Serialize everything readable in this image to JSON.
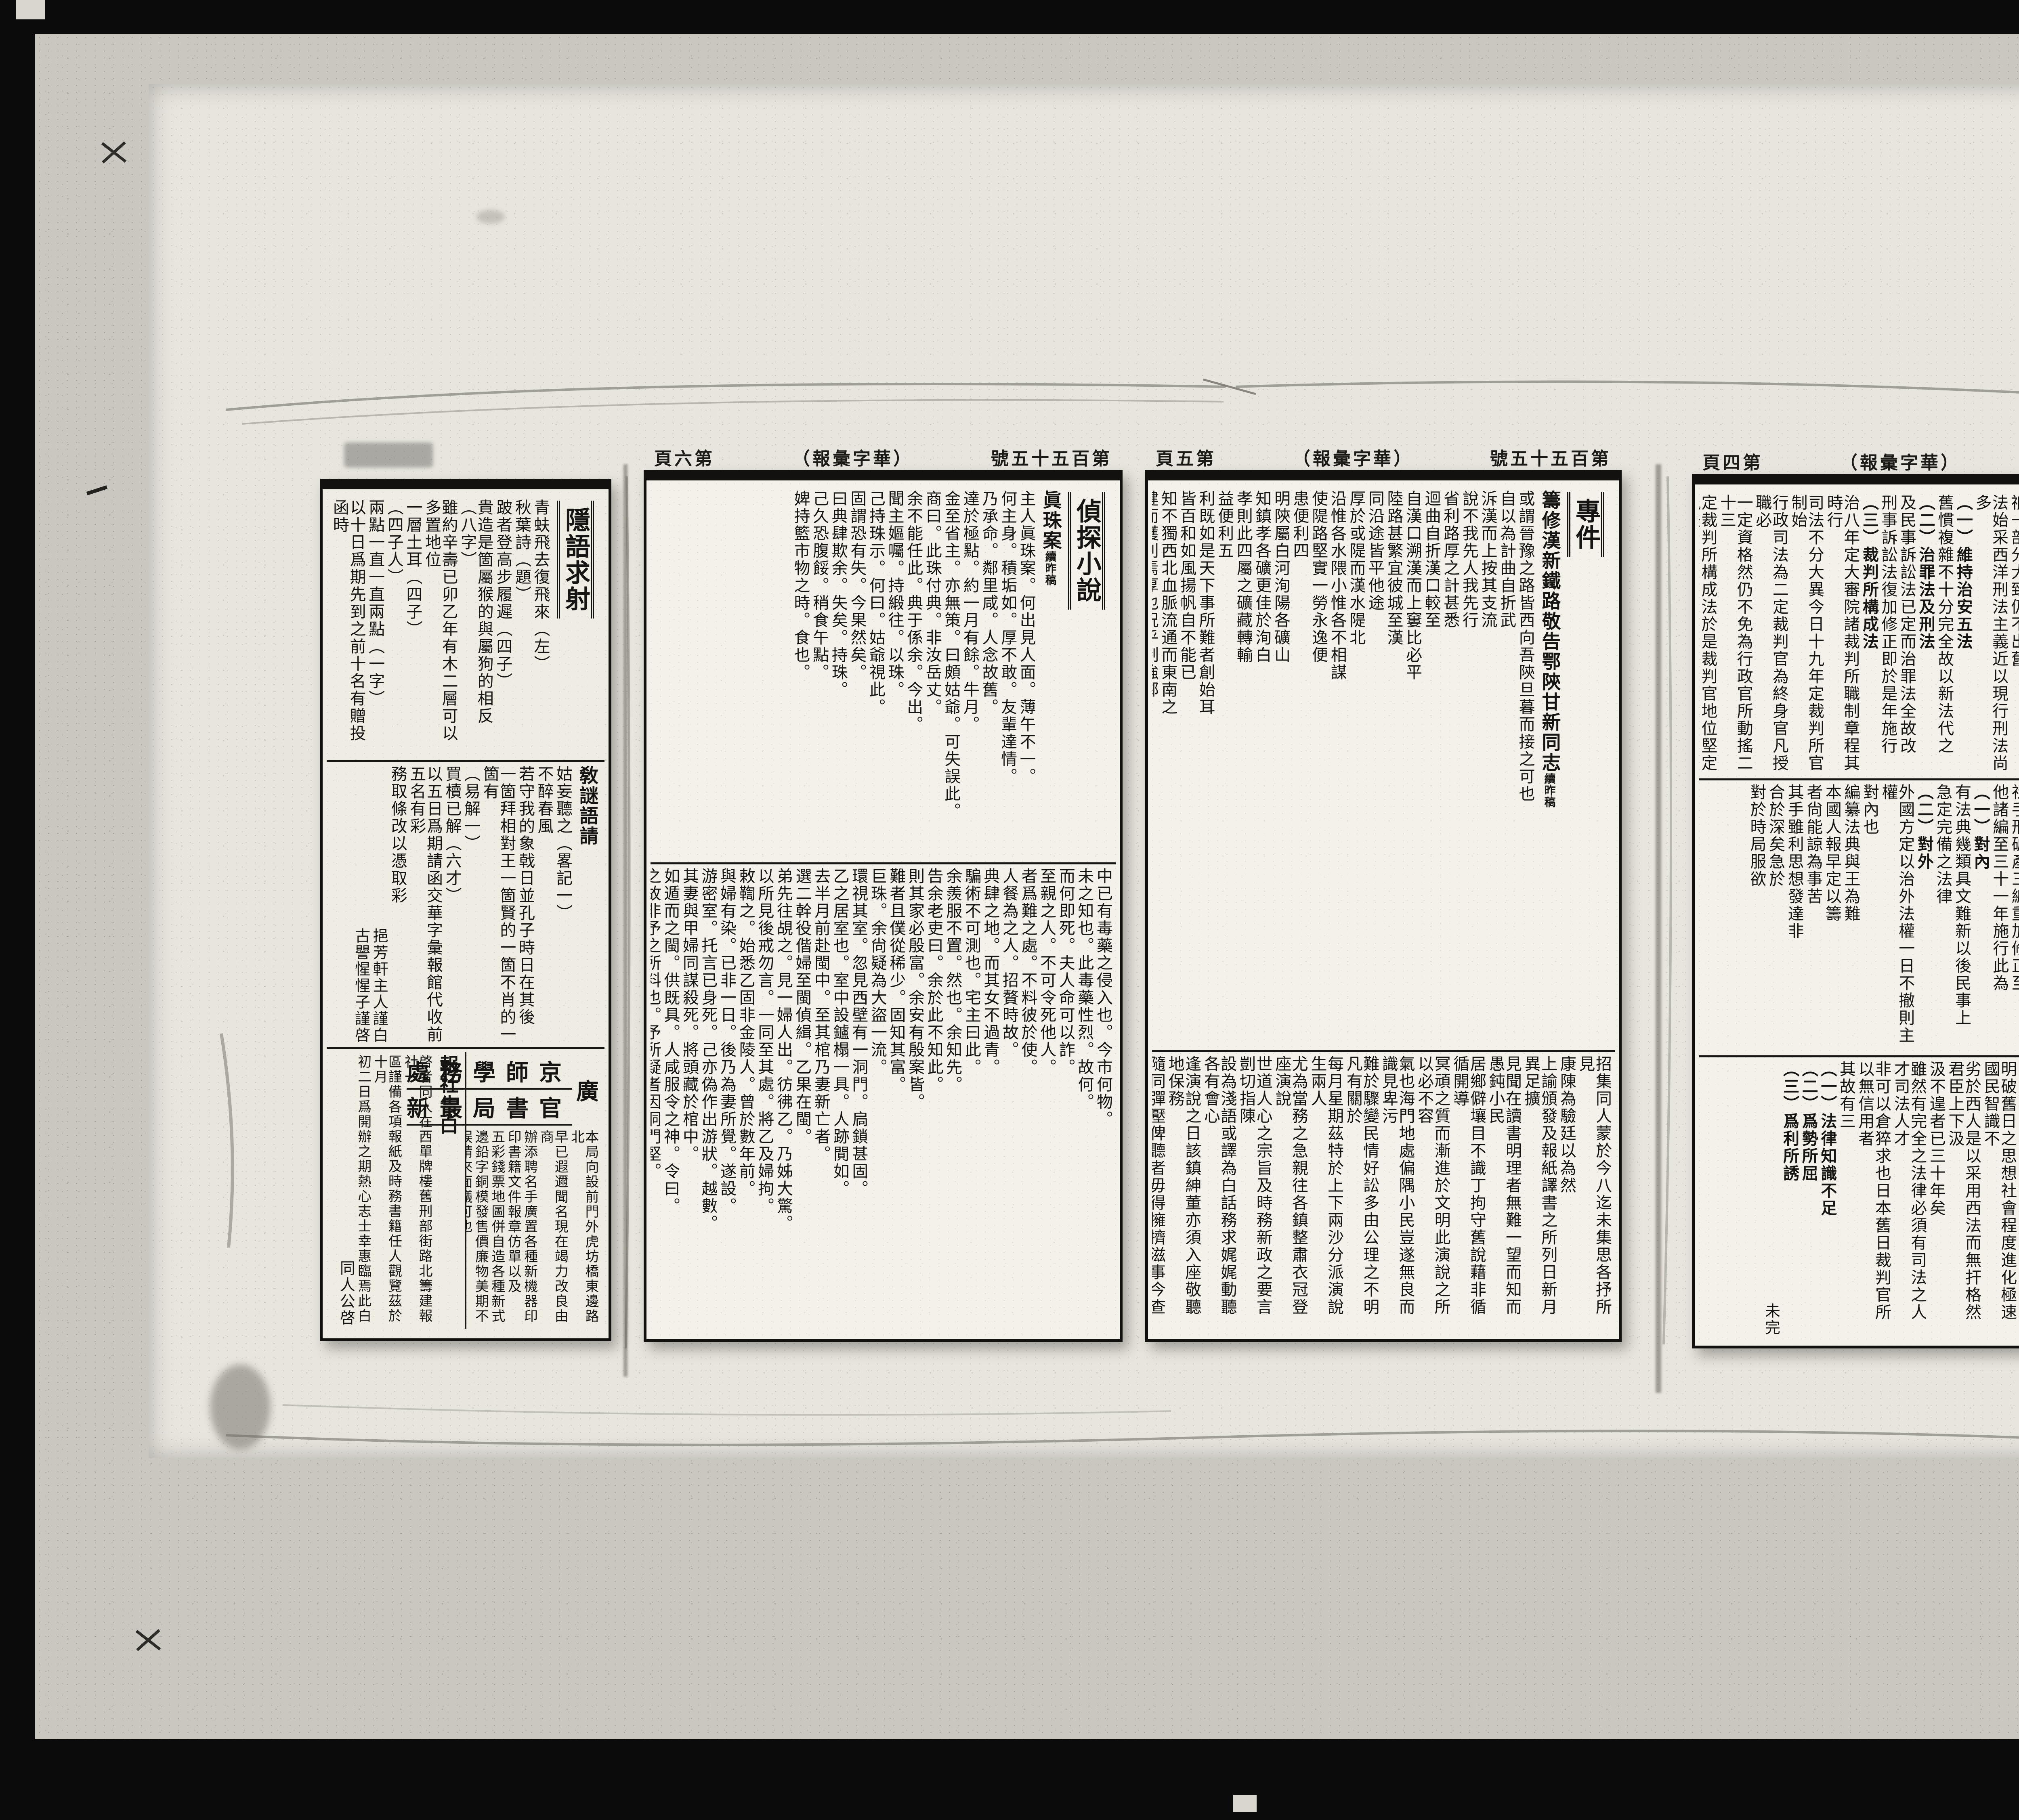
{
  "publication": {
    "issue": "第百五十五號",
    "name": "華字彙報",
    "name_paren": "（華字彙報）"
  },
  "panels": [
    {
      "page_label": null,
      "head": null,
      "blocks": [
        {
          "columns": [
            {
              "kind": "title",
              "text": "隱語求射"
            },
            {
              "kind": "body",
              "text": "青蚨飛去復飛來（左）"
            },
            {
              "kind": "body",
              "text": "秋葉詩（題）"
            },
            {
              "kind": "body",
              "text": "跛者登高步履遲（四子）"
            },
            {
              "kind": "body",
              "text": "貴造是箇屬猴的與屬狗的相反（八字）"
            },
            {
              "kind": "body",
              "text": "雖約辛壽已卯乙年有木二層可以多置地位"
            },
            {
              "kind": "body",
              "text": "一層土耳（四子）"
            },
            {
              "kind": "body",
              "text": "（四子人）"
            },
            {
              "kind": "body",
              "text": "兩點一直一直兩點（一字）"
            },
            {
              "kind": "body",
              "text": "以十日爲期先到之前十名有贈投函時"
            }
          ]
        },
        {
          "columns": [
            {
              "kind": "headline",
              "text": "敎謎語請"
            },
            {
              "kind": "body",
              "text": "姑妄聽之（畧記一）"
            },
            {
              "kind": "body",
              "text": "不醉春風"
            },
            {
              "kind": "body",
              "text": "若守我的象戟日並孔子時日在其後"
            },
            {
              "kind": "body",
              "text": "一箇拜相對王一箇賢的一箇不肖的一箇有"
            },
            {
              "kind": "body",
              "text": "（易解一）"
            },
            {
              "kind": "body",
              "text": "買櫝已解（六才）"
            },
            {
              "kind": "body",
              "text": "以五日爲期請函交華字彙報館代收前五名有彩"
            },
            {
              "kind": "body",
              "text": "務取條改以憑取彩"
            },
            {
              "kind": "sign",
              "text": "挹芳軒主人謹白"
            },
            {
              "kind": "sign",
              "text": "古譻惺惺子謹啓"
            }
          ]
        },
        {
          "split": true,
          "right": {
            "banner_rows": [
              "京師學務處",
              "官書局最新"
            ],
            "banner_side": "廣",
            "columns": [
              {
                "kind": "small",
                "text": "本局向設前門外虎坊橋東邊路北"
              },
              {
                "kind": "small",
                "text": "早已遐邇聞名現在竭力改良由商"
              },
              {
                "kind": "small",
                "text": "辦添聘名手廣置各種新機器印"
              },
              {
                "kind": "small",
                "text": "印書籍文件報章仿單以及"
              },
              {
                "kind": "small",
                "text": "五彩錢票地圖併自造各種新式"
              },
              {
                "kind": "small",
                "text": "邊鉛字銅模發售價廉物美期不"
              },
              {
                "kind": "small",
                "text": "誤請來面議可也"
              }
            ]
          },
          "left": {
            "columns": [
              {
                "kind": "headline",
                "text": "報社告白"
              },
              {
                "kind": "small",
                "text": "啓者同人在西單牌樓舊刑部街路北籌建報社一"
              },
              {
                "kind": "small",
                "text": "區謹備各項報紙及時務書籍任人觀覽茲於十月"
              },
              {
                "kind": "small",
                "text": "初二日爲開辦之期熱心志士幸惠臨焉此白"
              },
              {
                "kind": "sign",
                "text": "同人公啓"
              }
            ]
          }
        }
      ]
    },
    {
      "page_label": "第六頁",
      "head": {
        "issue": "第百五十五號",
        "paper": "（華字彙報）",
        "page": "第六頁"
      },
      "blocks": [
        {
          "columns": [
            {
              "kind": "title",
              "text": "偵探小說"
            },
            {
              "kind": "headline",
              "text": "眞珠案",
              "sub": "續昨稿"
            },
            {
              "kind": "body",
              "text": "主人眞珠案。何出見人面。薄午不一。"
            },
            {
              "kind": "body",
              "text": "何主身。積垢如。厚不敢。友輩達情。"
            },
            {
              "kind": "body",
              "text": "乃承命。鄰里咸。人念故舊。"
            },
            {
              "kind": "body",
              "text": "達於極點。約一月有餘。牛月。"
            },
            {
              "kind": "body",
              "text": "金至省主。亦無策。曰頗姑爺。可失誤此。"
            },
            {
              "kind": "body",
              "text": "商曰。此珠付典。非汝岳丈。"
            },
            {
              "kind": "body",
              "text": "余不能任此。典于係余。今出。"
            },
            {
              "kind": "body",
              "text": "聞主嫗囑。持緞往。以珠。"
            },
            {
              "kind": "body",
              "text": "己持珠示。何曰。姑爺視此。"
            },
            {
              "kind": "body",
              "text": "固謂恐有失。今果然矣。"
            },
            {
              "kind": "body",
              "text": "曰典肆欺余。失矣。持珠。"
            },
            {
              "kind": "body",
              "text": "己久恐腹餒。稍食午點。"
            },
            {
              "kind": "body",
              "text": "婢持籃市物之時。食也。"
            }
          ]
        },
        {
          "columns": [
            {
              "kind": "body",
              "text": "中已有毒藥之侵入也。今市何物。"
            },
            {
              "kind": "body",
              "text": "未之知也。此毒藥性烈。故何。"
            },
            {
              "kind": "body",
              "text": "而何即死。夫人命可以詐。"
            },
            {
              "kind": "body",
              "text": "至親之人。不可令死他人。"
            },
            {
              "kind": "body",
              "text": "者爲難之處。不料彼於使。"
            },
            {
              "kind": "body",
              "text": "人餐為之人。招贅時故。"
            },
            {
              "kind": "body",
              "text": "典肆之地。而其女不過青。"
            },
            {
              "kind": "body",
              "text": "騙術不可測也。宅主曰此。"
            },
            {
              "kind": "body",
              "text": "余羨服不置。然也。余知先。"
            },
            {
              "kind": "body",
              "text": "告余老吏曰。余於此不知此。"
            },
            {
              "kind": "body",
              "text": "則其家必殷富。余安有殷案皆。"
            },
            {
              "kind": "body",
              "text": "難者且僕從稀少。固知其富。"
            },
            {
              "kind": "body",
              "text": "巨珠。余尙疑為大盜一流。"
            },
            {
              "kind": "body",
              "text": "環視其室。忽見西壁有一洞門。扃鎖甚固。"
            },
            {
              "kind": "body",
              "text": "乙之居室也。室中設鑪榻一具。人跡閴如。"
            },
            {
              "kind": "body",
              "text": "去半月前赴閩中。至其棺乃妻新亡者。"
            },
            {
              "kind": "body",
              "text": "選二幹役偕婦至閩偵緝。乙果在閩。"
            },
            {
              "kind": "body",
              "text": "弟先往覘之。見一婦人出。彷彿乙。乃姊大驚。"
            },
            {
              "kind": "body",
              "text": "以所見後戒勿言。一同至其處。將乙及婦拘。"
            },
            {
              "kind": "body",
              "text": "敕鞫之。始悉乙固非金陵人。曾於數年前。"
            },
            {
              "kind": "body",
              "text": "與婦有染。已非一日。後乃為妻所覺。遂設。"
            },
            {
              "kind": "body",
              "text": "游密室。托言已身死。己亦偽作出游狀。越數。"
            },
            {
              "kind": "body",
              "text": "其妻與甲婦同謀殺死。將頭藏於棺中。"
            },
            {
              "kind": "body",
              "text": "如遁而之閩。供既具。人咸服令之神。令曰。"
            },
            {
              "kind": "body",
              "text": "之故非予之所料也。予所疑者因洞門堅。"
            },
            {
              "kind": "body",
              "text": "甲婦者卽乙耳。距意尙有不盡然者乎。"
            }
          ]
        }
      ]
    },
    {
      "page_label": "第五頁",
      "head": {
        "issue": "第百五十五號",
        "paper": "（華字彙報）",
        "page": "第五頁"
      },
      "blocks": [
        {
          "columns": [
            {
              "kind": "title",
              "text": "專件"
            },
            {
              "kind": "headline",
              "text": "籌修漢新鐵路敬告鄂陝甘新同志",
              "sub": "續昨稿"
            },
            {
              "kind": "body",
              "text": "或謂晉豫之路皆西向吾陝旦暮而接之可也"
            },
            {
              "kind": "body",
              "text": "自以為計曲自折武"
            },
            {
              "kind": "body",
              "text": "泝漢而上按其支流"
            },
            {
              "kind": "body",
              "text": "說不我先人我先行"
            },
            {
              "kind": "body",
              "text": "省利路厚之計甚悉"
            },
            {
              "kind": "body",
              "text": "迴曲自折漢口較至"
            },
            {
              "kind": "body",
              "text": "自漢口溯漢而上窶比必平"
            },
            {
              "kind": "body",
              "text": "陸路甚繁宜彼城至漢"
            },
            {
              "kind": "body",
              "text": "同沿途皆平他途"
            },
            {
              "kind": "body",
              "text": "厚於或隄而漢水隄北"
            },
            {
              "kind": "body",
              "text": "沿惟各水隈小惟各不相謀"
            },
            {
              "kind": "body",
              "text": "使隄路堅實一勞永逸便"
            },
            {
              "kind": "body",
              "text": "患便利四"
            },
            {
              "kind": "body",
              "text": "明陝屬白河洵陽各礦山"
            },
            {
              "kind": "body",
              "text": "知鎮孝各礦更佳於洵白"
            },
            {
              "kind": "body",
              "text": "孝則此四屬之礦藏轉輸"
            },
            {
              "kind": "body",
              "text": "益便利五"
            },
            {
              "kind": "body",
              "text": "利既如是天下事所難者創始耳"
            },
            {
              "kind": "body",
              "text": "皆百和如風揚帆自不能已"
            },
            {
              "kind": "body",
              "text": "知不獨西北血脈流通而東南之"
            },
            {
              "kind": "body",
              "text": "健而獲利焉厚也況乎制強鄰"
            },
            {
              "kind": "body",
              "text": "憲近如李伯行京卿籌"
            },
            {
              "kind": "body",
              "text": "魯園方伯籌江西鐵路各"
            },
            {
              "kind": "body",
              "text": "左右籌畫各法詳盡無遺仿行猶反手也"
            },
            {
              "kind": "body",
              "text": "單事須由國家提倡但省同志合力共作"
            },
            {
              "kind": "body",
              "text": "任人理財民自主之"
            },
            {
              "kind": "body",
              "text": "省舊日義舉善會生息設立漢新鐵路總銀行"
            },
            {
              "kind": "body",
              "text": "於陝甘新酌設子行可仿國民義務募款之"
            },
            {
              "kind": "body",
              "text": "致富致強實基於此"
            }
          ]
        },
        {
          "columns": [
            {
              "kind": "body",
              "text": "招集同人蒙於今八迄未集思各抒所見"
            },
            {
              "kind": "body",
              "text": "康陳為驗廷以為然"
            },
            {
              "kind": "body",
              "text": "上諭頒發及報紙譯書之所列日新月異足擴"
            },
            {
              "kind": "body",
              "text": "見聞在讀書明理者無難一望而知而愚鈍小民"
            },
            {
              "kind": "body",
              "text": "居鄉僻壤目不識丁拘守舊說藉非循循開導"
            },
            {
              "kind": "body",
              "text": "冥頑之質而漸進於文明此演說之所以必不容"
            },
            {
              "kind": "body",
              "text": "氣也海門地處偏隅小民豈遂無良而識見卑污"
            },
            {
              "kind": "body",
              "text": "難於驟變民情好訟多由公理之不明凡有關於"
            },
            {
              "kind": "body",
              "text": "每月星期茲特於上下兩沙分派演說生兩人"
            },
            {
              "kind": "body",
              "text": "尤為當務之急親往各鎮整肅衣冠登座演說"
            },
            {
              "kind": "body",
              "text": "世道人心之宗旨及時務新政之要言剴切指陳"
            },
            {
              "kind": "body",
              "text": "設為淺語或譯為白話務求娓娓動聽各有會心"
            },
            {
              "kind": "body",
              "text": "逢演說之日該鎮紳董亦須入座敬聽地保務"
            },
            {
              "kind": "body",
              "text": "隨同彈壓俾聽者毋得擁擠滋事今查有上下沙"
            },
            {
              "kind": "body",
              "text": "生振銓沈生則揚堪以派充每人月給車費伙食五"
            },
            {
              "kind": "body",
              "text": "元由本府捐廉給領以資津貼合行諭飭到該生"
            },
            {
              "kind": "body",
              "text": "卽便遵照每星期親赴各鎮演說以開風氣"
            },
            {
              "kind": "body",
              "text": "此舉實為擴充民智轉移澆風起見該生幸勿視為"
            },
            {
              "kind": "body",
              "text": "虛文致負委任切切特諭"
            }
          ]
        }
      ]
    },
    {
      "page_label": "第四頁",
      "head": {
        "issue": "第百五十五號",
        "paper": "（華字彙報）",
        "page": "第四頁"
      },
      "blocks": [
        {
          "columns": [
            {
              "kind": "title",
              "text": "專件"
            },
            {
              "kind": "headline",
              "text": "日本法政大學速成科第一次講談會筆記",
              "sub": "續昨稿"
            },
            {
              "kind": "body",
              "text": "明治二年定新律綱領為本六年頒改定律例"
            },
            {
              "kind": "body",
              "text": "祗一部分大致仍不出舊"
            },
            {
              "kind": "body",
              "text": "法始采西洋刑法主義近以現行刑法尚多"
            },
            {
              "kind": "item",
              "text": "（一）維持治安五法"
            },
            {
              "kind": "body",
              "text": "舊慣複雜不十分完全故以新法代之"
            },
            {
              "kind": "item",
              "text": "（二）治罪法及刑法"
            },
            {
              "kind": "body",
              "text": "及民事訴訟法已定而治罪法全故改"
            },
            {
              "kind": "body",
              "text": "刑事訴訟法復加修正即於是年施行"
            },
            {
              "kind": "item",
              "text": "（三）裁判所構成法"
            },
            {
              "kind": "body",
              "text": "治八年定大審院諸裁判所職制章程其時行"
            },
            {
              "kind": "body",
              "text": "司法不分大異今日十九年定裁判所官制始"
            },
            {
              "kind": "body",
              "text": "行政司法為二定裁判官為終身官凡授職必"
            },
            {
              "kind": "body",
              "text": "一定資格然仍不免為行政官所動搖二十三"
            },
            {
              "kind": "body",
              "text": "定裁判所構成法於是裁判官地位堅定執法"
            },
            {
              "kind": "item",
              "text": "（四）民法"
            },
            {
              "kind": "body",
              "text": "十三年編定民法通過議會議員多言不便上"
            },
            {
              "kind": "body",
              "text": "請緩改未施行是為舊民法二十九年重編民"
            },
            {
              "kind": "body",
              "text": "法前三編成三十一年後二編成"
            }
          ]
        },
        {
          "columns": [
            {
              "kind": "body",
              "text": "新民法"
            },
            {
              "kind": "item",
              "text": "（五）民事訴訟法"
            },
            {
              "kind": "body",
              "text": "明治六年定訴答文例訴答文"
            },
            {
              "kind": "body",
              "text": "時別無訴訟法惟此件稍爲近"
            },
            {
              "kind": "body",
              "text": "國主義定民事訴訟法二十四"
            },
            {
              "kind": "item",
              "text": "（六）商法"
            },
            {
              "kind": "body",
              "text": "明治二十三年定商法諸所規"
            },
            {
              "kind": "body",
              "text": "社手形破產三編重加修正至"
            },
            {
              "kind": "body",
              "text": "他諸編至三十一年施行此為"
            },
            {
              "kind": "item",
              "text": "（一）對內"
            },
            {
              "kind": "body",
              "text": "有法典幾類具文難新以後民事上"
            },
            {
              "kind": "body",
              "text": "急定完備之法律"
            },
            {
              "kind": "item",
              "text": "（二）對外"
            },
            {
              "kind": "body",
              "text": "外國方定以治外法權一日不撤則主權"
            },
            {
              "kind": "body",
              "text": "對內也"
            },
            {
              "kind": "body",
              "text": "編纂法典與王為難"
            },
            {
              "kind": "body",
              "text": "本國人報早定以籌"
            },
            {
              "kind": "body",
              "text": "者尙能諒為事苦"
            },
            {
              "kind": "body",
              "text": "其手雖利思想發達非"
            },
            {
              "kind": "body",
              "text": "合於深矣急於"
            },
            {
              "kind": "body",
              "text": "對於時局服欲"
            }
          ]
        },
        {
          "columns": [
            {
              "kind": "body",
              "text": "步驟次而不能進步主義則係純必不可"
            },
            {
              "kind": "body",
              "text": "而改雖然以進步主義之法律治不進步之人民是"
            },
            {
              "kind": "body",
              "text": "徇外人之要求而不計國民之程度也越程度以為"
            },
            {
              "kind": "body",
              "text": "治其弊必滋其患必烈日本維新以來吸泰西之文"
            },
            {
              "kind": "body",
              "text": "明破舊日之思想社會程度進化極速國民智識不"
            },
            {
              "kind": "body",
              "text": "劣於西人是以采用西法而無扞格然君臣上下汲"
            },
            {
              "kind": "body",
              "text": "汲不遑者已三十年矣"
            },
            {
              "kind": "body",
              "text": "雖然有完全之法律必須有司法之人才司法人才"
            },
            {
              "kind": "body",
              "text": "非可以倉猝求也日本舊日裁判官所以無信用者"
            },
            {
              "kind": "body",
              "text": "其故有三"
            },
            {
              "kind": "item",
              "text": "（一）法律知識不足"
            },
            {
              "kind": "item",
              "text": "（二）爲勢所屈"
            },
            {
              "kind": "item",
              "text": "（三）爲利所誘"
            },
            {
              "kind": "end",
              "text": "未完"
            }
          ]
        }
      ]
    }
  ]
}
